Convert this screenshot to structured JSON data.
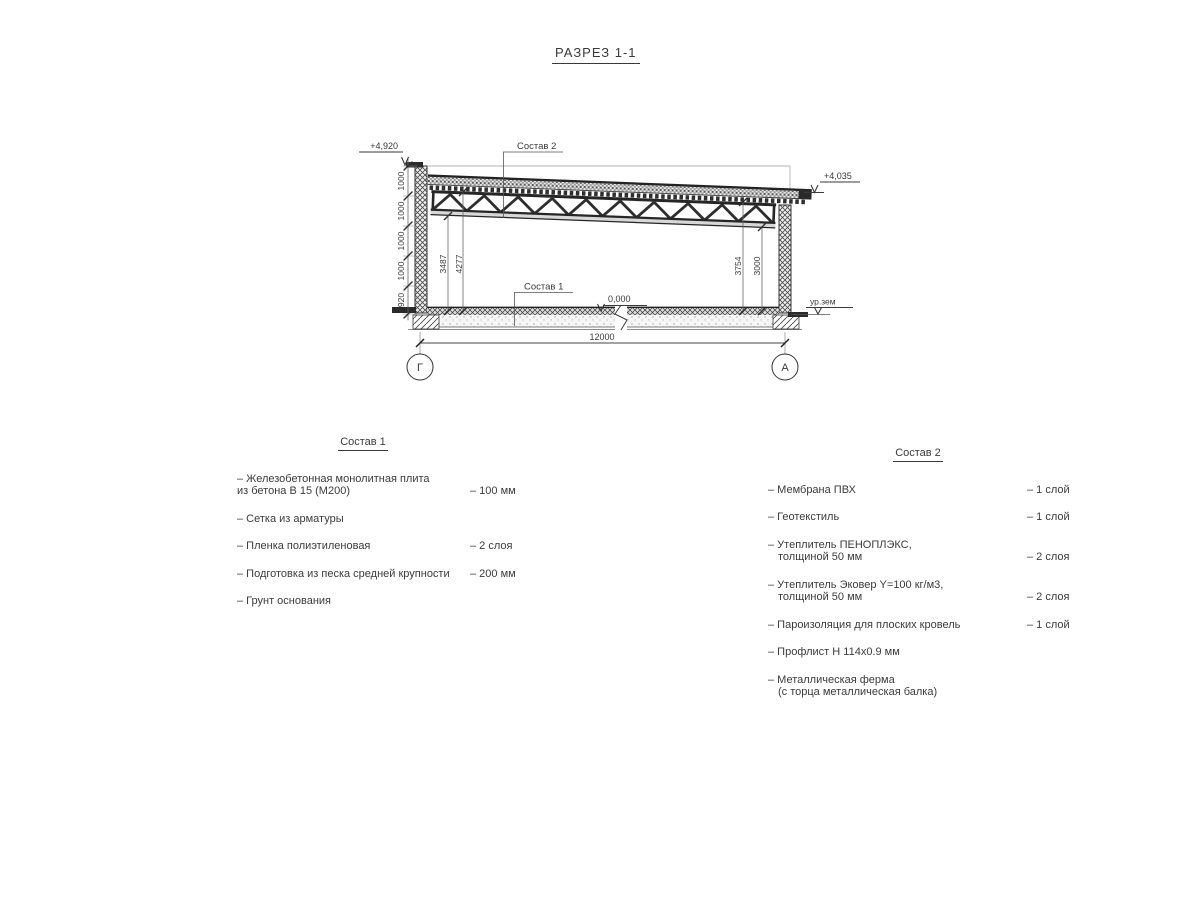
{
  "title": "РАЗРЕЗ 1-1",
  "drawing": {
    "callout1": "Состав 1",
    "callout2": "Состав 2",
    "elevations": {
      "top_left": "+4,920",
      "top_right": "+4,035",
      "floor": "0,000",
      "ground": "ур.зем"
    },
    "dim_chain_left": [
      "1000",
      "1000",
      "1000",
      "1000",
      "920"
    ],
    "inner_dims": {
      "left_small": "3487",
      "left_big": "4277",
      "right_big": "3754",
      "right_small": "3000"
    },
    "span_dim": "12000",
    "axes": [
      "Г",
      "А"
    ]
  },
  "lists": {
    "sostav1": {
      "header": "Состав 1",
      "items": [
        {
          "name": "– Железобетонная  монолитная плита\nиз бетона В 15 (М200)",
          "value": "– 100 мм"
        },
        {
          "name": "– Сетка из арматуры",
          "value": ""
        },
        {
          "name": "– Пленка полиэтиленовая",
          "value": "– 2 слоя"
        },
        {
          "name": "– Подготовка из песка средней крупности",
          "value": "– 200 мм"
        },
        {
          "name": "– Грунт основания",
          "value": ""
        }
      ]
    },
    "sostav2": {
      "header": "Состав 2",
      "items": [
        {
          "name": "– Мембрана ПВХ",
          "value": "– 1 слой"
        },
        {
          "name": "– Геотекстиль",
          "value": "– 1 слой"
        },
        {
          "name": "– Утеплитель ПЕНОПЛЭКС,\nтолщиной 50 мм",
          "value": "– 2 слоя"
        },
        {
          "name": "– Утеплитель Эковер Y=100 кг/м3,\nтолщиной 50 мм",
          "value": "– 2 слоя"
        },
        {
          "name": "– Пароизоляция для плоских кровель",
          "value": "– 1 слой"
        },
        {
          "name": "– Профлист Н 114х0.9 мм",
          "value": ""
        },
        {
          "name": "– Металлическая ферма\n(с торца металлическая балка)",
          "value": ""
        }
      ]
    }
  }
}
